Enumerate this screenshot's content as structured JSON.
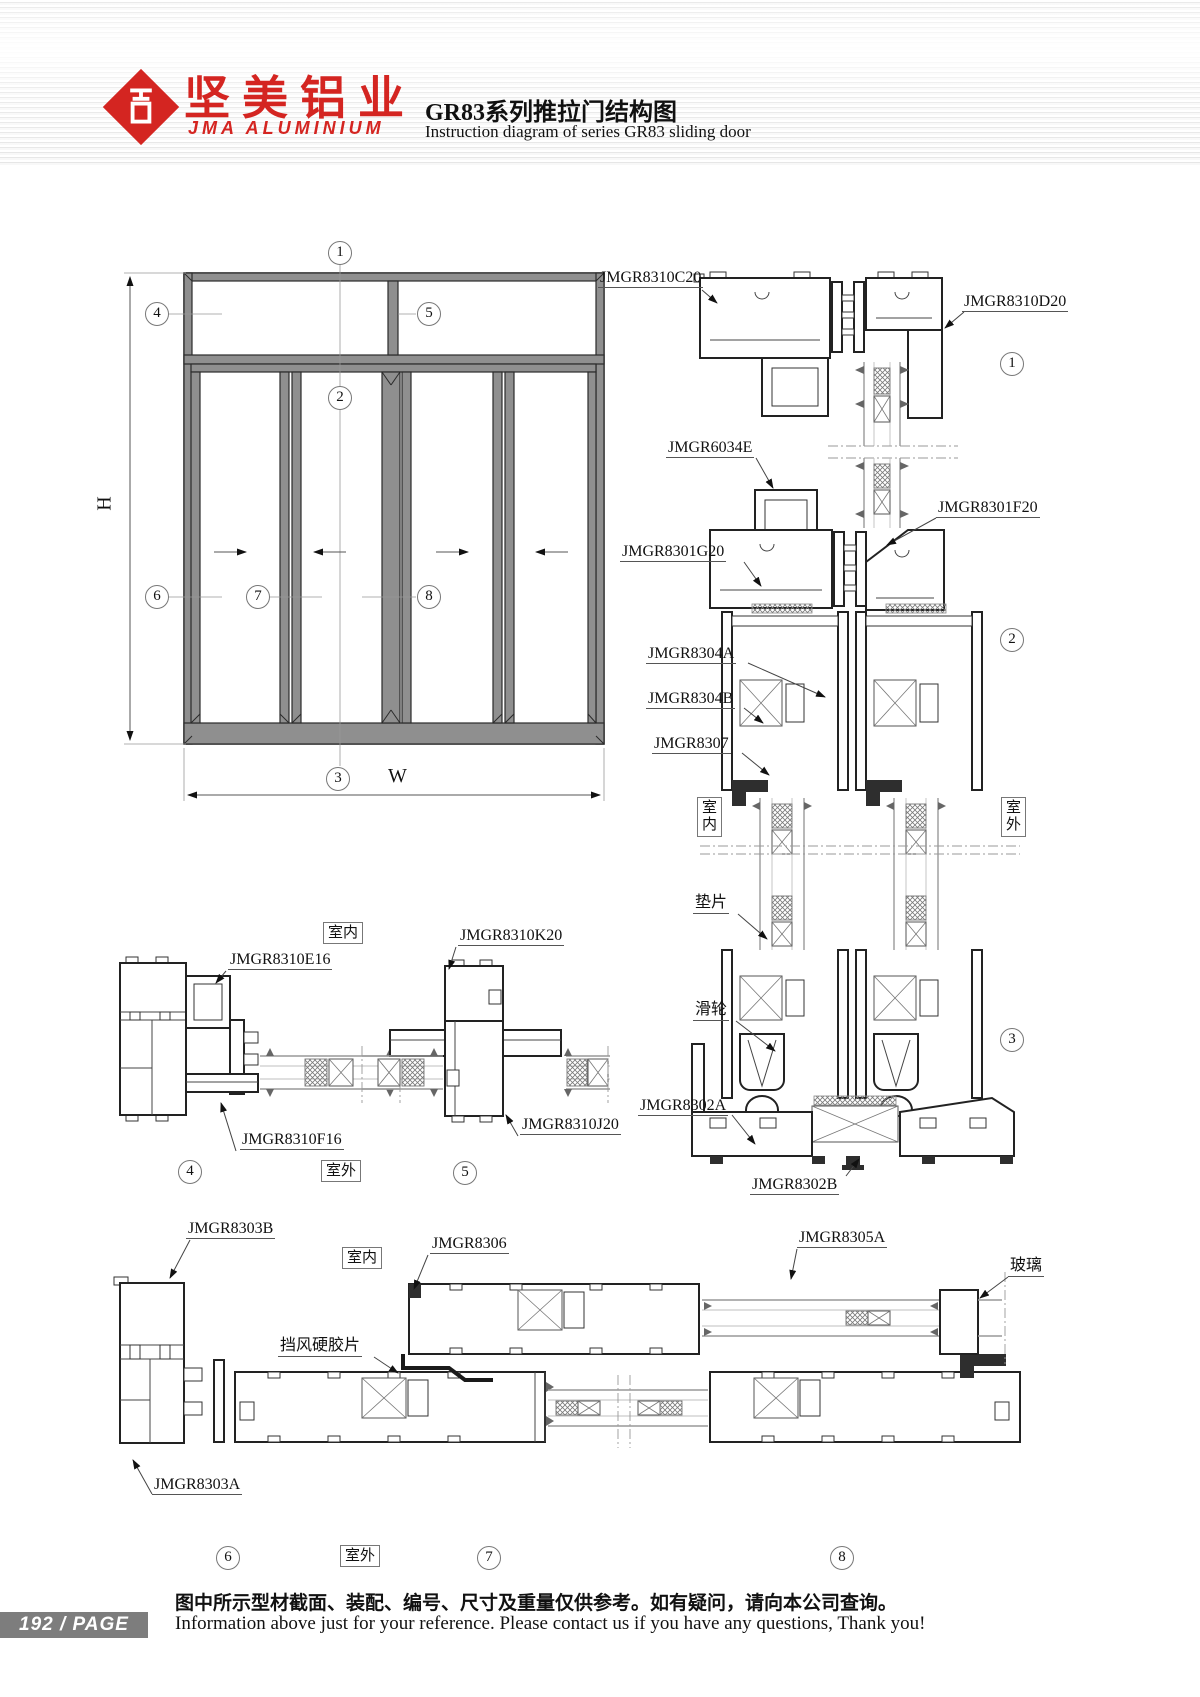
{
  "header": {
    "logo_title": "坚美铝业",
    "logo_subtitle": "JMA ALUMINIUM",
    "title_cn": "GR83系列推拉门结构图",
    "title_en": "Instruction diagram of series GR83 sliding door"
  },
  "front_view": {
    "dim_height": "H",
    "dim_width": "W",
    "markers": [
      "1",
      "2",
      "3",
      "4",
      "5",
      "6",
      "7",
      "8"
    ]
  },
  "labels": {
    "indoor": "室内",
    "outdoor": "室外",
    "gasket": "垫片",
    "roller": "滑轮",
    "glass": "玻璃",
    "wind_strip": "挡风硬胶片"
  },
  "parts": {
    "p8310C20": "JMGR8310C20",
    "p8310D20": "JMGR8310D20",
    "p6034E": "JMGR6034E",
    "p8301F20": "JMGR8301F20",
    "p8301G20": "JMGR8301G20",
    "p8304A": "JMGR8304A",
    "p8304B": "JMGR8304B",
    "p8307": "JMGR8307",
    "p8302A": "JMGR8302A",
    "p8302B": "JMGR8302B",
    "p8310E16": "JMGR8310E16",
    "p8310K20": "JMGR8310K20",
    "p8310F16": "JMGR8310F16",
    "p8310J20": "JMGR8310J20",
    "p8303B": "JMGR8303B",
    "p8306": "JMGR8306",
    "p8305A": "JMGR8305A",
    "p8303A": "JMGR8303A"
  },
  "footer": {
    "page_badge": "192 / PAGE",
    "note_cn": "图中所示型材截面、装配、编号、尺寸及重量仅供参考。如有疑问，请向本公司查询。",
    "note_en": "Information above just for your reference. Please contact us if you have any questions, Thank you!"
  }
}
